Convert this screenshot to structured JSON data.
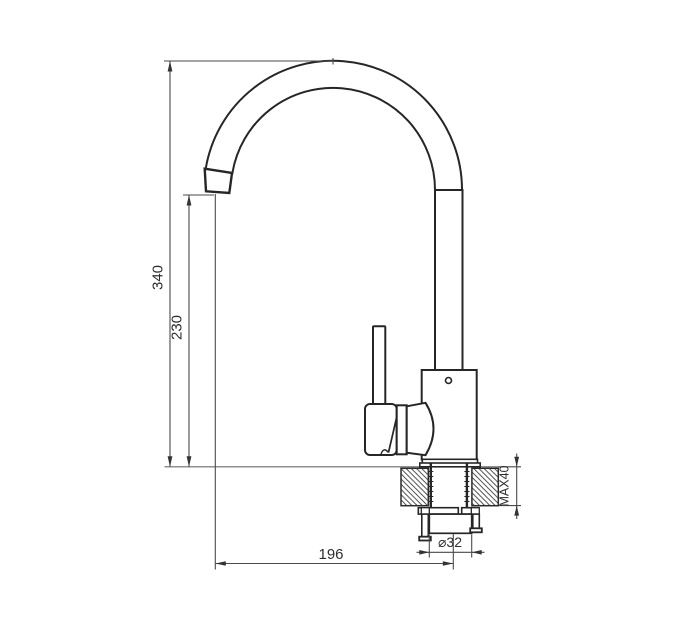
{
  "drawing": {
    "subject": "kitchen-faucet-installation-side-view",
    "dimensions": {
      "overall_height": "340",
      "spout_outlet_height": "230",
      "spout_reach": "196",
      "hole_diameter": "⌀32",
      "max_mounting_thickness": "MAX40"
    },
    "colors": {
      "outline": "#262626",
      "dimension_line": "#4a4a4a",
      "surface_line": "#8f8f8f",
      "text": "#2e2e2e",
      "background": "#ffffff"
    }
  }
}
